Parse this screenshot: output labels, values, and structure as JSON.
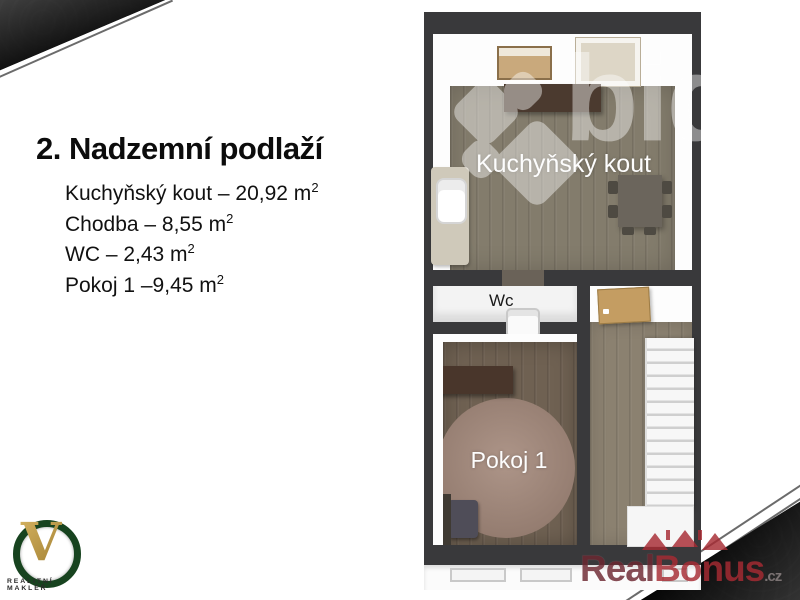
{
  "slide": {
    "title": "2. Nadzemní podlaží",
    "rooms": [
      {
        "text": "Kuchyňský kout – 20,92 m",
        "sup": "2"
      },
      {
        "text": "Chodba – 8,55 m",
        "sup": "2"
      },
      {
        "text": "WC – 2,43 m",
        "sup": "2"
      },
      {
        "text": "Pokoj 1 –9,45 m",
        "sup": "2"
      }
    ]
  },
  "floorplan": {
    "labels": {
      "kitchen": "Kuchyňský kout",
      "wc": "Wc",
      "room1": "Pokoj 1"
    },
    "watermark": "bid"
  },
  "branding": {
    "agent_logo": {
      "letter": "V",
      "caption": "REALITNÍ MAKLÉŘ"
    },
    "watermark_logo": {
      "part1": "Real",
      "part2": "Bonus",
      "suffix": ".cz"
    }
  },
  "theme": {
    "colors": {
      "wall": "#39393b",
      "kitchen_floor": "#837c6c",
      "hall_floor": "#8b8170",
      "room_floor": "#6f6152",
      "rug": "#a4897b",
      "door": "#c49d62",
      "counter": "#4b3a2f",
      "desk": "#49362b",
      "shelf_wood": "#c9a97c",
      "brand_red": "#a72b33",
      "brand_dark_red": "#6d2731",
      "brand_green": "#17431f",
      "gold": "#b8913f"
    }
  }
}
